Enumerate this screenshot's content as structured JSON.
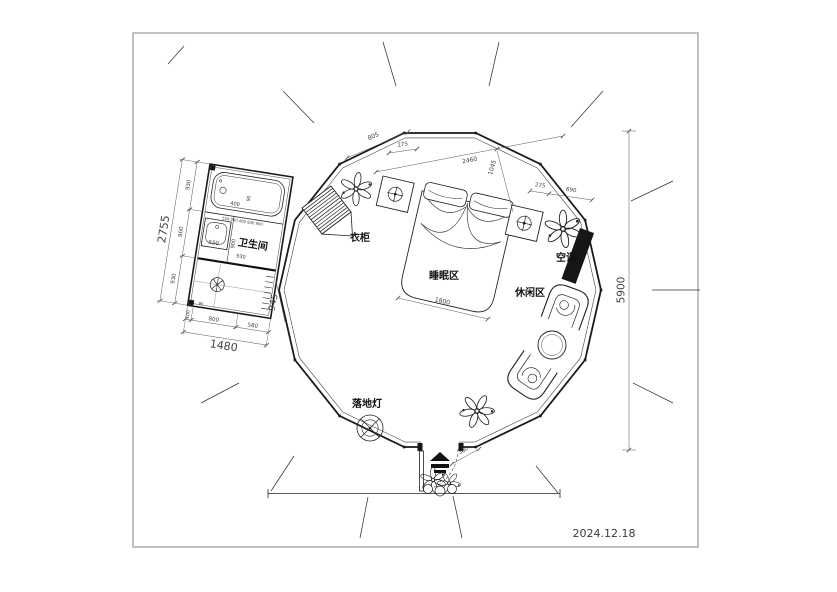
{
  "drawing": {
    "date": "2024.12.18",
    "labels": {
      "bathroom": "卫生间",
      "wardrobe": "衣柜",
      "sleeping_area": "睡眠区",
      "leisure_area": "休闲区",
      "air_conditioner": "空调",
      "floor_lamp": "落地灯"
    },
    "dims": {
      "bath_total_h": "2755",
      "bath_h1": "930",
      "bath_h2": "900",
      "bath_h3": "930",
      "bath_total_w": "1480",
      "bath_w1": "100",
      "bath_w2": "800",
      "bath_w3": "580",
      "bath_offset": "945",
      "bath_post": "95",
      "tub_w": "400",
      "tub_off": "90",
      "wall_chain": "550 900 400 930 900",
      "sink_w": "550",
      "sink_d": "900",
      "sink_span": "930",
      "panel_a": "805",
      "panel_b": "275",
      "span_main": "2460",
      "span_side": "1045",
      "panel_c": "275",
      "panel_d": "690",
      "bed_w": "1800",
      "height_total": "5900",
      "door_off": "360"
    },
    "colors": {
      "line": "#1a1a1a",
      "dim": "#555555",
      "frame": "#a6a6a6",
      "solid_fill": "#161616"
    }
  }
}
